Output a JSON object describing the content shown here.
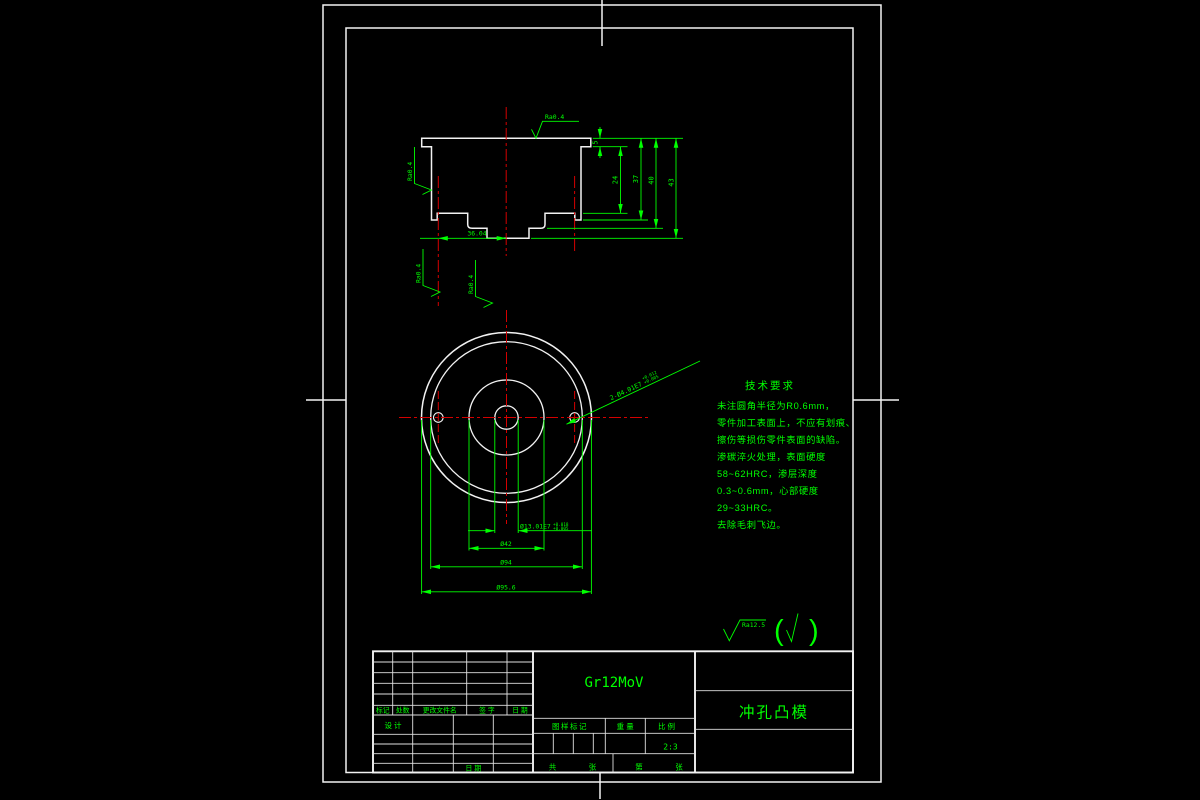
{
  "colors": {
    "background": "#000000",
    "lines": "#f2f2f2",
    "dimensions": "#00ff00",
    "centerlines": "#d40000"
  },
  "section_view": {
    "dim_5": "5",
    "dim_24": "24",
    "dim_37": "37",
    "dim_40": "40",
    "dim_43": "43",
    "dim_36_04": "36.04",
    "roughness_top": "Ra0.4",
    "roughness_left": "Ra0.4",
    "roughness_bottom_left": "Ra0.4",
    "roughness_bottom_right": "Ra0.4"
  },
  "circle_view": {
    "dim_13": "Ø13.01E7",
    "dim_13_tol_upper": "+0.018",
    "dim_13_tol_lower": "+0.005",
    "dim_42": "Ø42",
    "dim_94": "Ø94",
    "dim_95_6": "Ø95.6",
    "holes_label": "2-Ø4.01E7",
    "holes_tol_upper": "+0.012",
    "holes_tol_lower": "+0.005"
  },
  "tech_req": {
    "title": "技术要求",
    "lines": [
      "未注圆角半径为R0.6mm，",
      "零件加工表面上，不应有划痕、",
      "擦伤等损伤零件表面的缺陷。",
      "渗碳淬火处理，表面硬度",
      "58~62HRC，渗层深度",
      "0.3~0.6mm，心部硬度",
      "29~33HRC。",
      "去除毛刺飞边。"
    ]
  },
  "surface_note": {
    "ra": "Ra12.5",
    "paren_open": "(",
    "paren_close": ")"
  },
  "title_block": {
    "material": "Gr12MoV",
    "part_name": "冲孔凸模",
    "scale_value": "2:3",
    "labels": {
      "mark": "标记",
      "qty": "处数",
      "file": "更改文件名",
      "sign": "签  字",
      "date": "日  期",
      "design": "设  计",
      "date_bottom": "日  期",
      "stamp": "图样标记",
      "weight": "重  量",
      "scale": "比  例",
      "total": "共",
      "sheet": "张",
      "no": "第",
      "sheet2": "张"
    }
  }
}
